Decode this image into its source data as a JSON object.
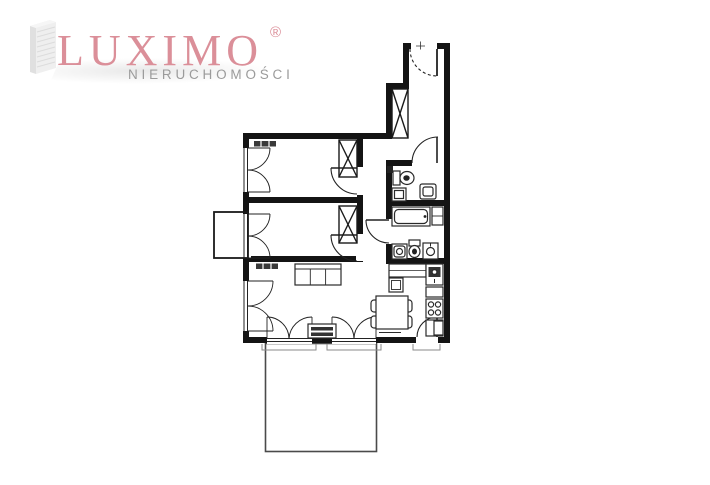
{
  "logo": {
    "brand": "LUXIMO",
    "registered": "®",
    "tagline": "NIERUCHOMOŚCI"
  },
  "colors": {
    "brand_pink": "#db8f99",
    "tagline_gray": "#9b9b9b",
    "wall_black": "#141414",
    "furniture_line": "#2a2a2a",
    "sill_gray": "#8a8a8a",
    "background": "#ffffff"
  },
  "plan": {
    "kind": "apartment-floor-plan",
    "rooms": [
      "entrance-hall",
      "corridor",
      "wc",
      "bathroom",
      "kitchen",
      "bedroom-1",
      "bedroom-2",
      "living-room",
      "balcony"
    ],
    "fixtures": [
      "entrance-door",
      "wardrobe",
      "toilet",
      "washbasin",
      "bathtub",
      "washing-machine",
      "kitchen-sink",
      "stove",
      "dining-table",
      "chairs",
      "sofa",
      "sideboard",
      "radiator",
      "window-casement"
    ]
  }
}
